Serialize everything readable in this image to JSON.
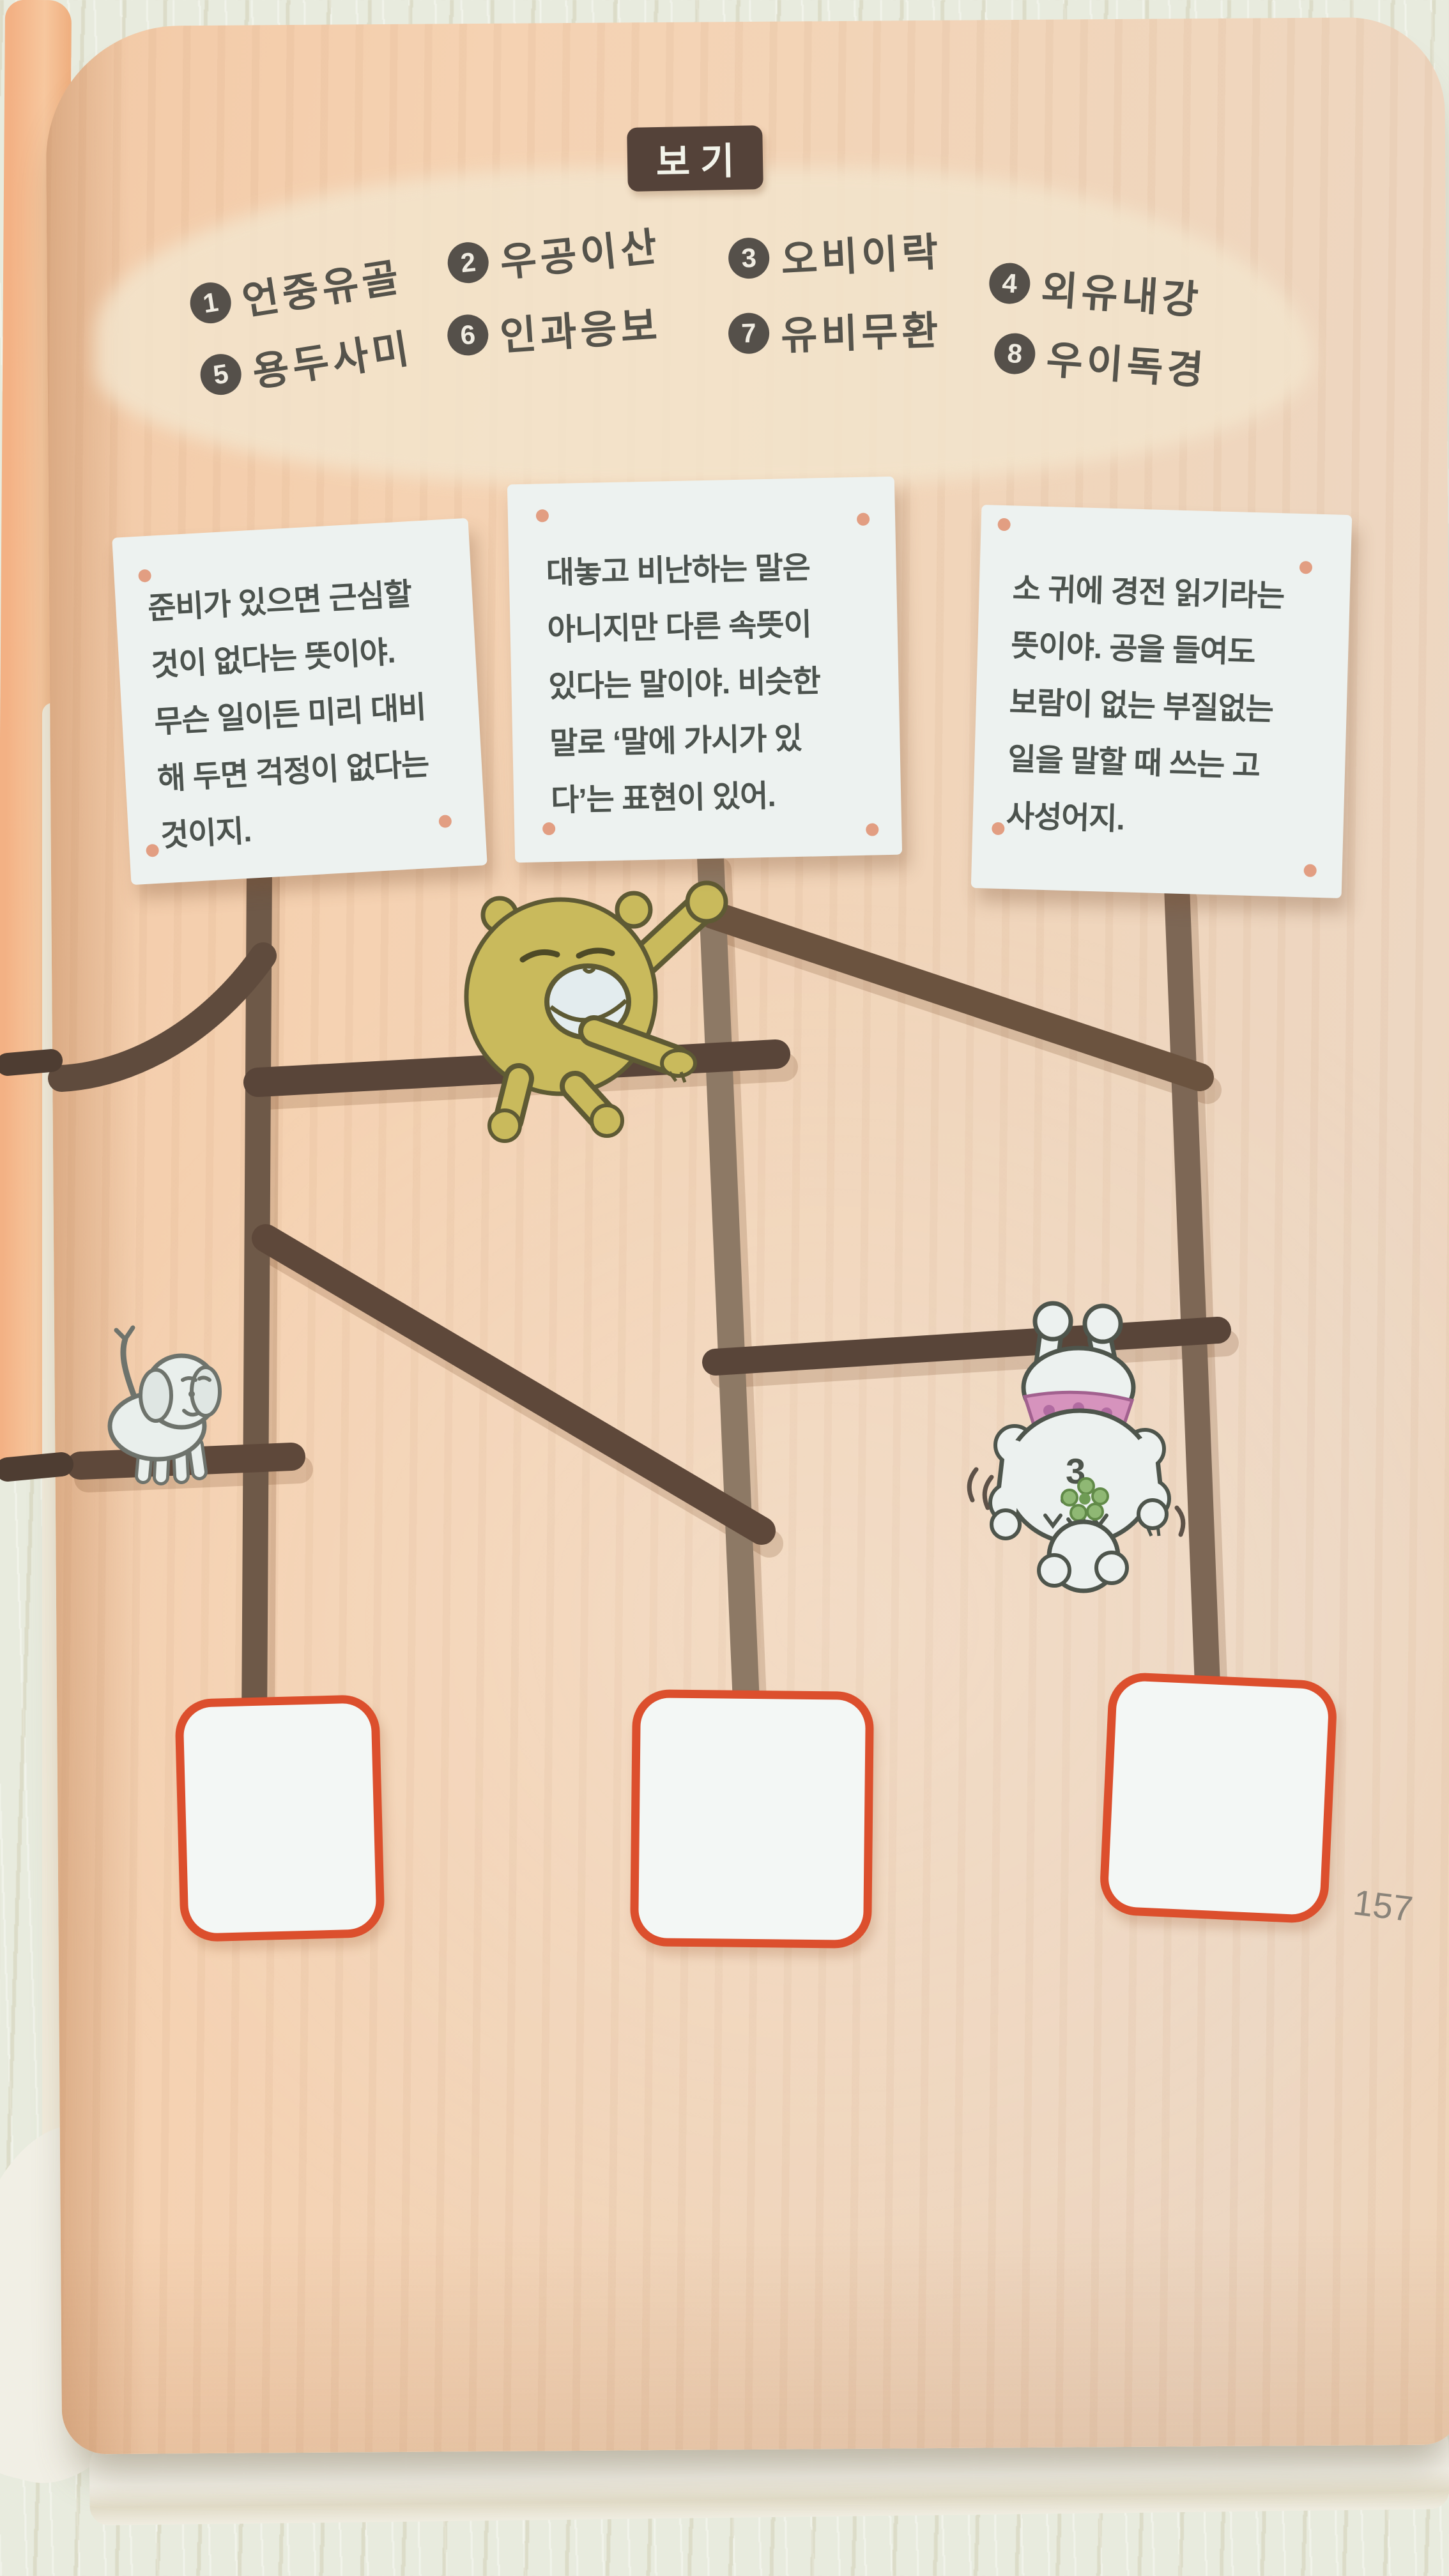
{
  "page_number": "157",
  "header": {
    "badge": "보기"
  },
  "options": [
    {
      "num": "1",
      "label": "언중유골"
    },
    {
      "num": "2",
      "label": "우공이산"
    },
    {
      "num": "3",
      "label": "오비이락"
    },
    {
      "num": "4",
      "label": "외유내강"
    },
    {
      "num": "5",
      "label": "용두사미"
    },
    {
      "num": "6",
      "label": "인과응보"
    },
    {
      "num": "7",
      "label": "유비무환"
    },
    {
      "num": "8",
      "label": "우이독경"
    }
  ],
  "cards": [
    {
      "text": "준비가 있으면 근심할\n것이 없다는 뜻이야.\n무슨 일이든 미리 대비\n해 두면 걱정이 없다는\n것이지."
    },
    {
      "text": "대놓고 비난하는 말은\n아니지만 다른 속뜻이\n있다는 말이야. 비슷한\n말로 ‘말에 가시가 있\n다’는 표현이 있어."
    },
    {
      "text": "소 귀에 경전 읽기라는\n뜻이야. 공을 들여도\n보람이 없는 부질없는\n일을 말할 때 쓰는 고\n사성어지."
    }
  ],
  "poodle_mark": "3",
  "characters": [
    "bear",
    "puppy",
    "poodle"
  ],
  "colors": {
    "table_bg": "#e8ebde",
    "page_bg": "#f3d0b0",
    "options_panel": "#f3e5cd",
    "badge_bg": "#544239",
    "text_dark": "#55534b",
    "card_bg": "#edf2f0",
    "pin_dot": "#e2997b",
    "ladder_dark": "#594539",
    "ladder_light": "#8d7965",
    "answer_border": "#dc4f2d",
    "bear_yellow": "#c9ba5c",
    "bandana_pink": "#d693bd"
  }
}
